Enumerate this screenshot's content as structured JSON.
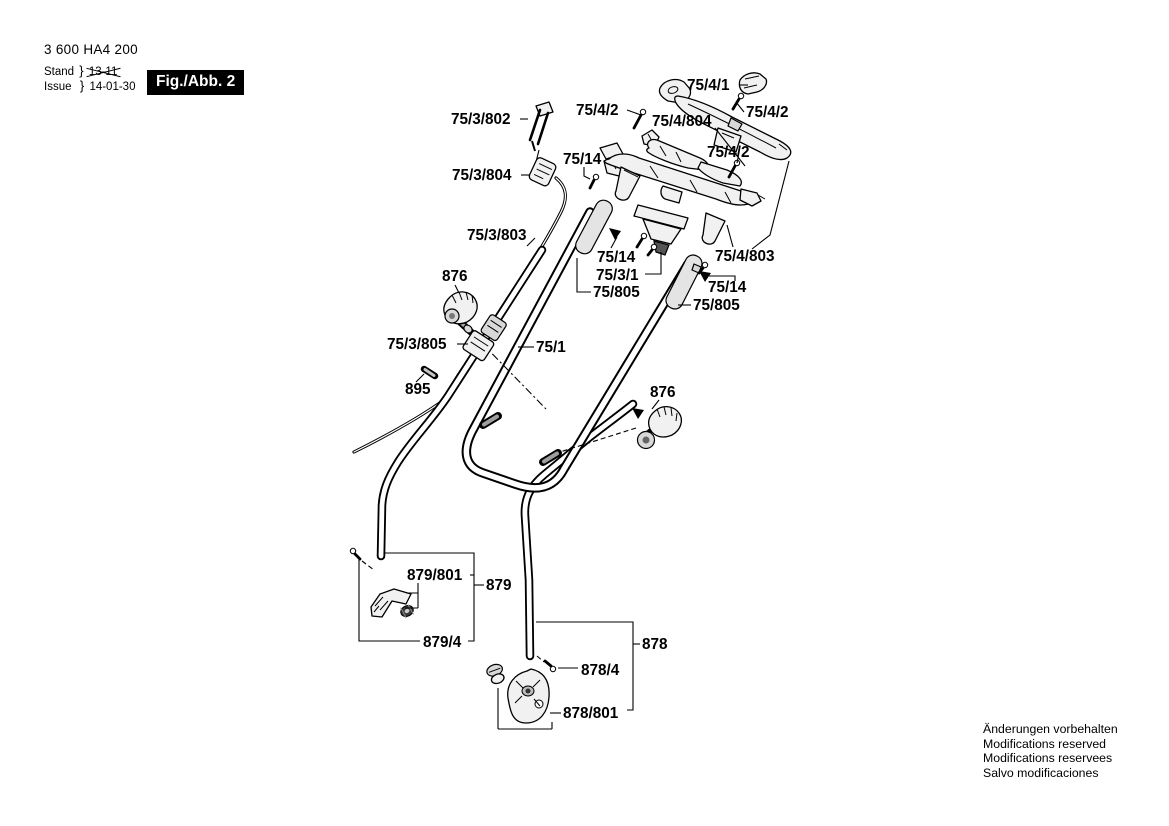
{
  "header": {
    "part_number": "3 600 HA4 200",
    "stand_label": "Stand",
    "issue_label": "Issue",
    "brace": "}",
    "stand_value": "13-11",
    "issue_value": "14-01-30",
    "fig_label": "Fig./Abb. 2"
  },
  "footer": {
    "line1": "Änderungen vorbehalten",
    "line2": "Modifications reserved",
    "line3": "Modifications reservees",
    "line4": "Salvo modificaciones"
  },
  "labels": {
    "l75_4_1": "75/4/1",
    "l75_4_2_top": "75/4/2",
    "l75_4_2_right": "75/4/2",
    "l75_4_2_mid": "75/4/2",
    "l75_4_804": "75/4/804",
    "l75_3_802": "75/3/802",
    "l75_14_top": "75/14",
    "l75_3_804": "75/3/804",
    "l75_3_803": "75/3/803",
    "l75_14_left": "75/14",
    "l75_3_1": "75/3/1",
    "l75_805_left": "75/805",
    "l75_4_803": "75/4/803",
    "l75_14_right": "75/14",
    "l75_805_right": "75/805",
    "l876_left": "876",
    "l75_3_805": "75/3/805",
    "l75_1": "75/1",
    "l895": "895",
    "l876_right": "876",
    "l879_801": "879/801",
    "l879": "879",
    "l879_4": "879/4",
    "l878": "878",
    "l878_4": "878/4",
    "l878_801": "878/801"
  },
  "colors": {
    "ink": "#000000",
    "paper": "#ffffff",
    "fig_box_bg": "#000000",
    "fig_box_text": "#ffffff"
  }
}
